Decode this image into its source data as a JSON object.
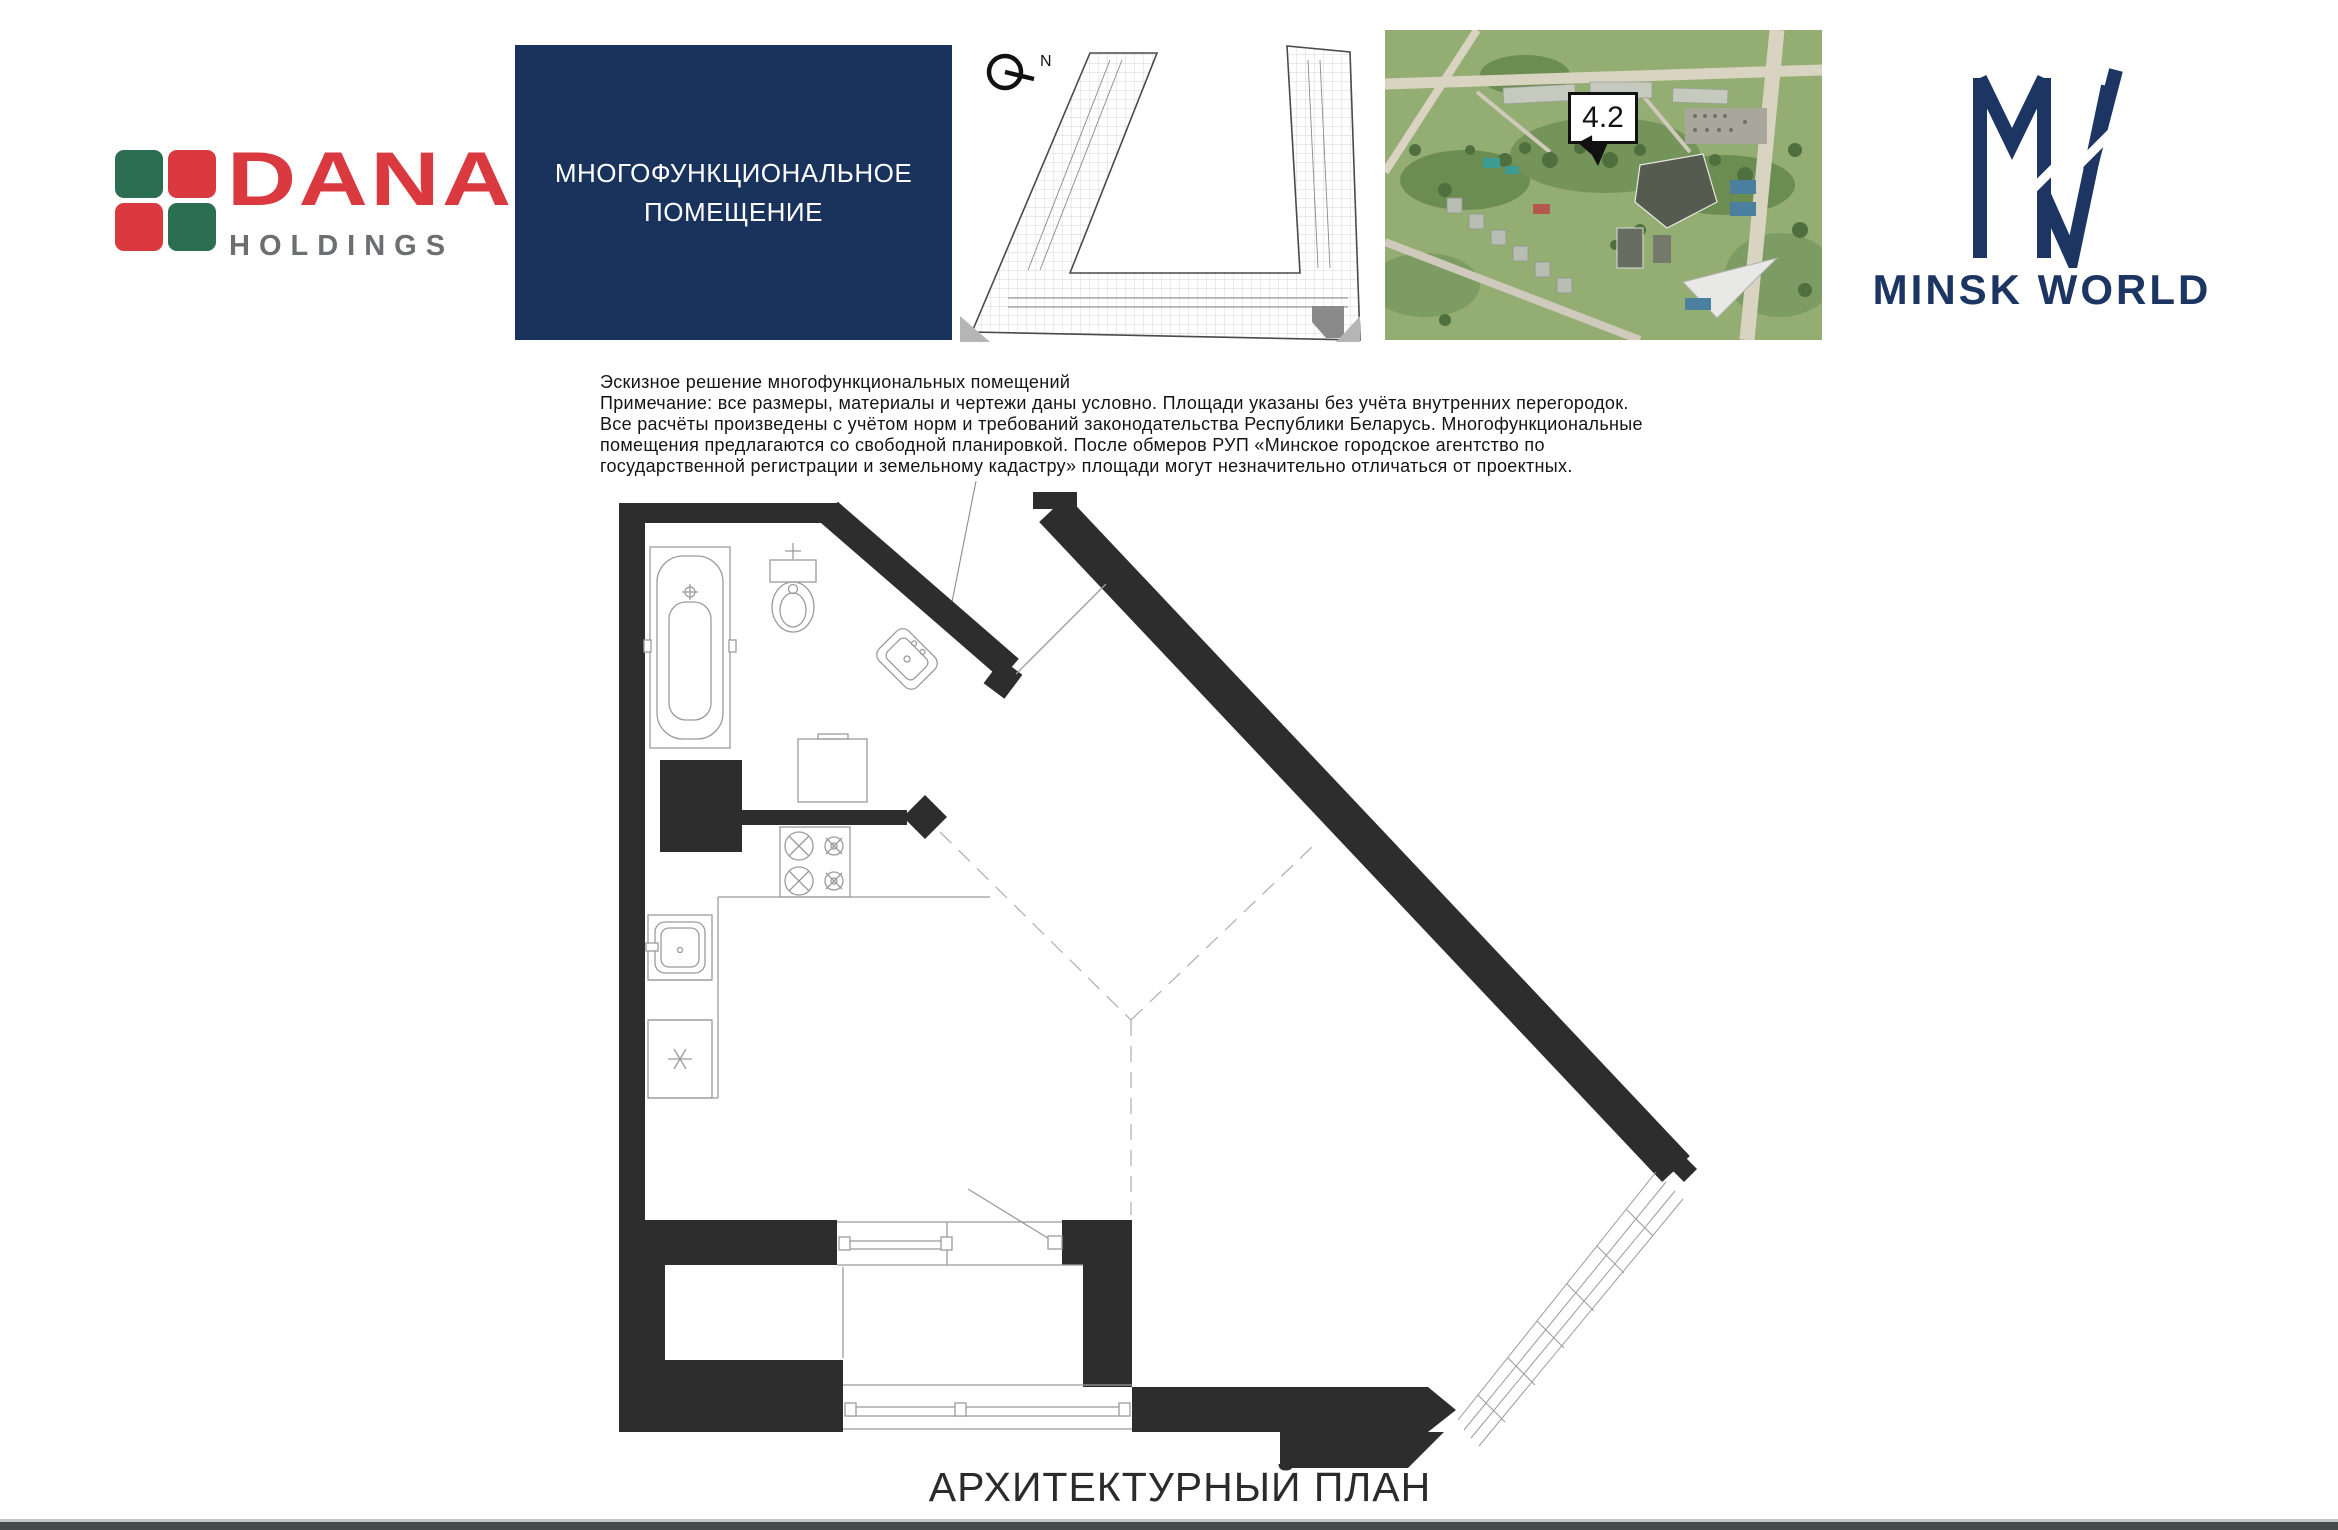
{
  "header": {
    "dana_logo": {
      "name": "DANA",
      "sub": "HOLDINGS"
    },
    "title_box": {
      "line1": "МНОГОФУНКЦИОНАЛЬНОЕ",
      "line2": "ПОМЕЩЕНИЕ"
    },
    "key_plan": {
      "north_label": "N"
    },
    "aerial": {
      "building_label": "4.2"
    },
    "minsk_world": {
      "brand": "MINSK WORLD"
    }
  },
  "disclaimer": {
    "line1": "Эскизное решение многофункциональных помещений",
    "line2": "Примечание: все размеры, материалы и чертежи даны условно. Площади указаны без учёта внутренних перегородок.",
    "line3": "Все расчёты произведены с учётом норм и требований законодательства Республики Беларусь. Многофункциональные",
    "line4": "помещения предлагаются со свободной планировкой. После обмеров РУП «Минское городское агентство по",
    "line5": "государственной регистрации и земельному кадастру» площади могут незначительно отличаться от проектных."
  },
  "plan": {
    "caption": "АРХИТЕКТУРНЫЙ ПЛАН"
  },
  "colors": {
    "brand_navy": "#1a335d",
    "dana_red": "#d9393f",
    "dana_green": "#2b6e51",
    "dana_gray": "#6d6e71",
    "wall_black": "#2d2d2d",
    "footer_gray": "#47494d"
  }
}
